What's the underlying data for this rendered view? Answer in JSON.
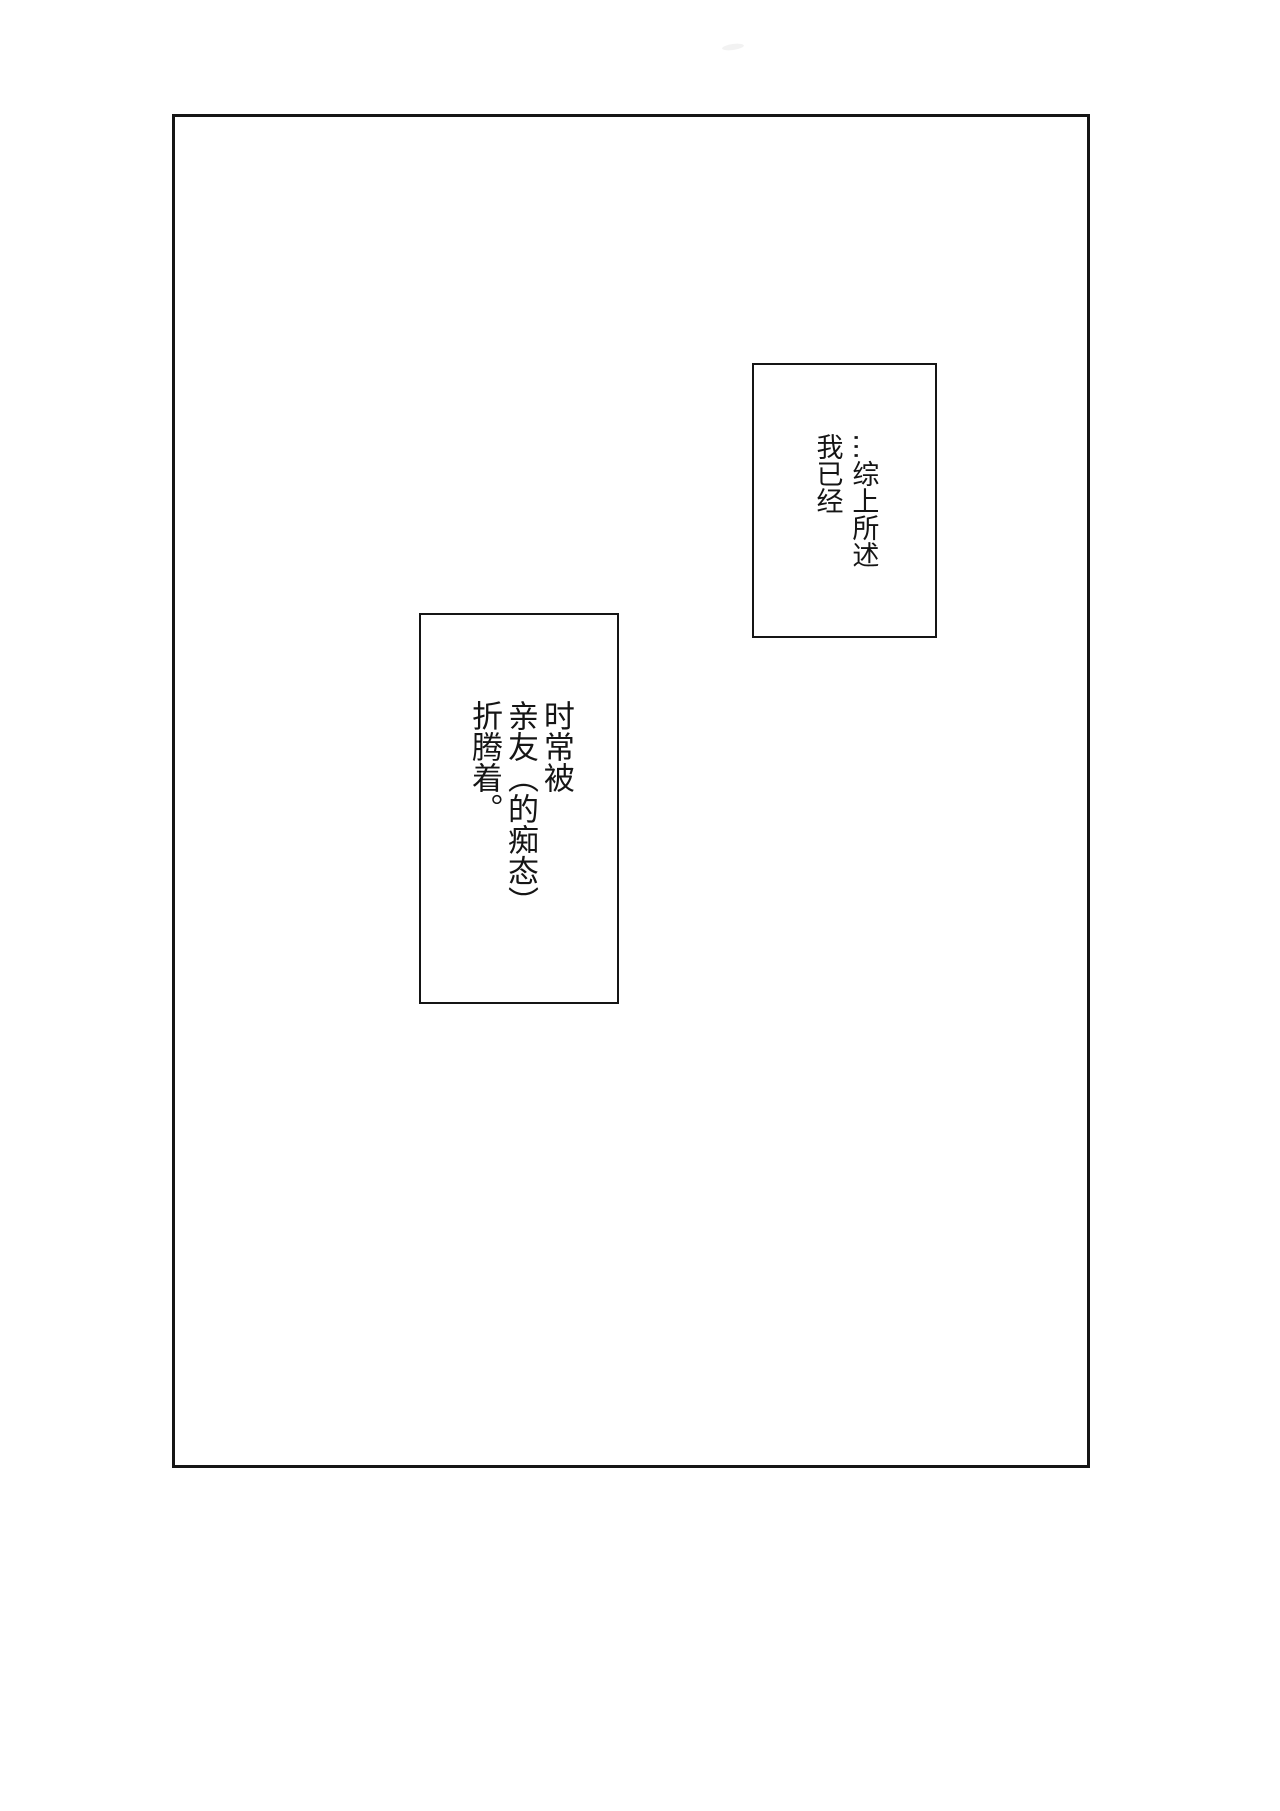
{
  "colors": {
    "background": "#ffffff",
    "ink": "#151515"
  },
  "panel": {
    "caption_top_right": {
      "text": "…综上所述\n我已经"
    },
    "caption_middle": {
      "text": "时常被\n亲友（的痴态）\n折腾着。"
    }
  }
}
